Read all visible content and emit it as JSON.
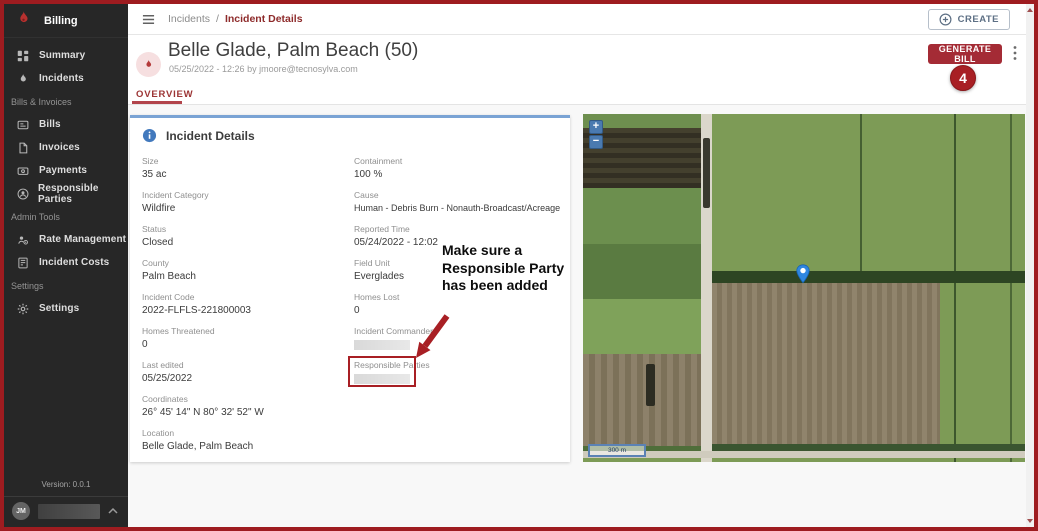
{
  "colors": {
    "frame_red": "#9e1c20",
    "brand_red": "#a42b35",
    "annotation_red": "#a81f24",
    "card_accent_blue": "#7aa3d4",
    "info_blue": "#4279bd",
    "marker_blue": "#2f86e0"
  },
  "sidebar": {
    "title": "Billing",
    "section_bills": "Bills & Invoices",
    "section_admin": "Admin Tools",
    "section_settings": "Settings",
    "items": {
      "summary": "Summary",
      "incidents": "Incidents",
      "bills": "Bills",
      "invoices": "Invoices",
      "payments": "Payments",
      "responsible_parties": "Responsible Parties",
      "rate_management": "Rate Management",
      "incident_costs": "Incident Costs",
      "settings": "Settings"
    },
    "version": "Version: 0.0.1",
    "avatar": "JM"
  },
  "topbar": {
    "breadcrumb_parent": "Incidents",
    "breadcrumb_separator": "/",
    "breadcrumb_current": "Incident Details",
    "create_label": "CREATE"
  },
  "header": {
    "title": "Belle Glade, Palm Beach (50)",
    "subtitle": "05/25/2022 - 12:26 by jmoore@tecnosylva.com",
    "generate_bill_label": "GENERATE BILL"
  },
  "tabs": {
    "overview": "OVERVIEW"
  },
  "card": {
    "title": "Incident Details",
    "left": [
      {
        "label": "Size",
        "value": "35 ac"
      },
      {
        "label": "Incident Category",
        "value": "Wildfire"
      },
      {
        "label": "Status",
        "value": "Closed"
      },
      {
        "label": "County",
        "value": "Palm Beach"
      },
      {
        "label": "Incident Code",
        "value": "2022-FLFLS-221800003"
      },
      {
        "label": "Homes Threatened",
        "value": "0"
      },
      {
        "label": "Last edited",
        "value": "05/25/2022"
      },
      {
        "label": "Coordinates",
        "value": "26° 45' 14\" N 80° 32' 52\" W"
      },
      {
        "label": "Location",
        "value": "Belle Glade, Palm Beach"
      }
    ],
    "right": [
      {
        "label": "Containment",
        "value": "100 %"
      },
      {
        "label": "Cause",
        "value": "Human - Debris Burn - Nonauth-Broadcast/Acreage"
      },
      {
        "label": "Reported Time",
        "value": "05/24/2022 - 12:02"
      },
      {
        "label": "Field Unit",
        "value": "Everglades"
      },
      {
        "label": "Homes Lost",
        "value": "0"
      },
      {
        "label": "Incident Commander",
        "value": ""
      },
      {
        "label": "Responsible Parties",
        "value": ""
      }
    ]
  },
  "annotation": {
    "note": "Make sure a Responsible Party has been added",
    "badge": "4"
  },
  "map": {
    "zoom_in_label": "+",
    "zoom_out_label": "−",
    "scale_label": "300 m"
  }
}
